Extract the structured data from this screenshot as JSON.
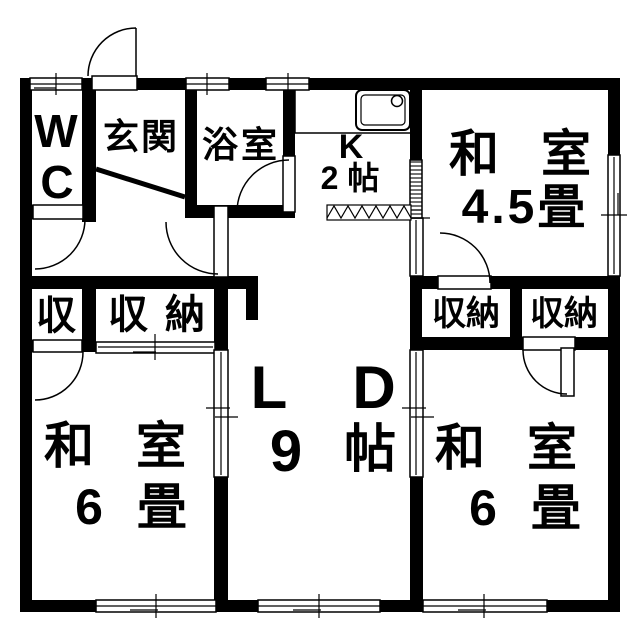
{
  "colors": {
    "wall": "#000000",
    "background": "#ffffff",
    "line": "#000000"
  },
  "rooms": {
    "wc": {
      "line1": "W",
      "line2": "C"
    },
    "entrance": {
      "label": "玄関"
    },
    "bathroom": {
      "label": "浴室"
    },
    "kitchen": {
      "label": "K",
      "size": "2 帖"
    },
    "japanese_room_45": {
      "label": "和 室",
      "size": "4.5畳"
    },
    "living_dining": {
      "letter_l": "L",
      "letter_d": "D",
      "size_number": "9",
      "size_unit": "帖"
    },
    "japanese_room_6_left": {
      "label": "和 室",
      "size": "6 畳"
    },
    "japanese_room_6_right": {
      "label": "和 室",
      "size": "6 畳"
    },
    "closet_small": {
      "label": "収"
    },
    "closet_left": {
      "label": "収 納"
    },
    "closet_right_a": {
      "label": "収納"
    },
    "closet_right_b": {
      "label": "収納"
    }
  }
}
